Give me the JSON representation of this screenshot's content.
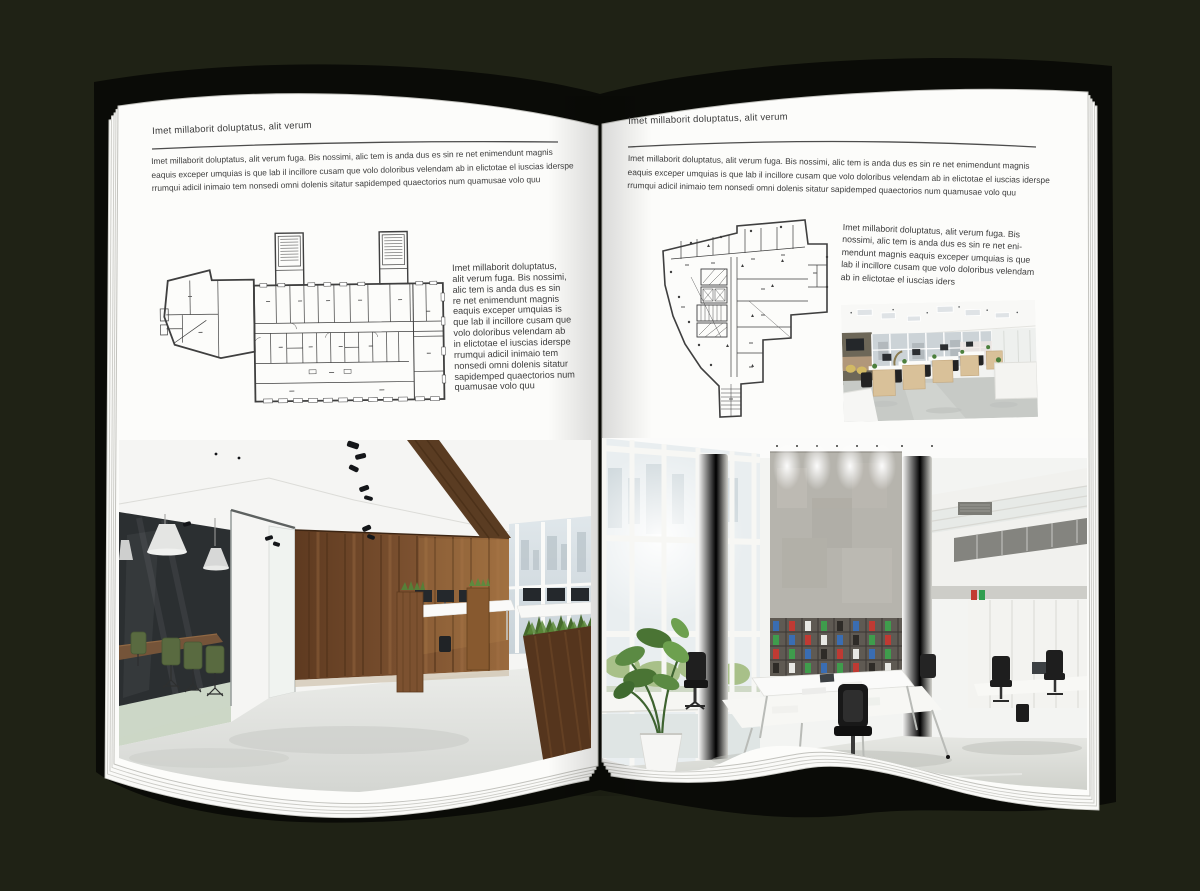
{
  "palette": {
    "background": "#1f2215",
    "cover": "#0a0b07",
    "page": "#fcfcfa",
    "text": "#3c3c3c",
    "rule": "#4d4d4d",
    "plan_line": "#3f3f3f",
    "wood": "#7a4f2c",
    "meeting_chair_green": "#4c5e2f",
    "binder_red": "#bf3a33",
    "binder_green": "#3f9c4c",
    "binder_blue": "#3a6db2"
  },
  "left_page": {
    "header": "Imet millaborit doluptatus, alit verum",
    "intro": "Imet millaborit doluptatus, alit verum fuga. Bis nossimi, alic tem is anda dus es sin re net enimendunt magnis\neaquis exceper umquias is que lab il incillore cusam que volo doloribus velendam ab in elictotae el iuscias iderspe\nrrumqui adicil inimaio tem nonsedi omni dolenis sitatur sapidemped quaectorios num quamusae volo quu",
    "caption": "Imet millaborit doluptatus,\nalit verum fuga. Bis nossimi,\nalic tem is anda dus es sin\nre net enimendunt magnis\neaquis exceper umquias is\nque lab il incillore cusam que\nvolo doloribus velendam ab\nin elictotae el iuscias iderspe\nrrumqui adicil inimaio tem\nnonsedi omni dolenis sitatur\nsapidemped quaectorios num\nquamusae volo quu",
    "floor_plan": "wide-office-building-floor-plan",
    "photo": "loft-office-with-glass-meeting-room"
  },
  "right_page": {
    "header": "Imet millaborit doluptatus, alit verum",
    "intro": "Imet millaborit doluptatus, alit verum fuga. Bis nossimi, alic tem is anda dus es sin re net enimendunt magnis\neaquis exceper umquias is que lab il incillore cusam que volo doloribus velendam ab in elictotae el iuscias iderspe\nrrumqui adicil inimaio tem nonsedi omni dolenis sitatur sapidemped quaectorios num quamusae volo quu",
    "caption": "Imet millaborit doluptatus, alit verum fuga. Bis\nnossimi, alic tem is anda dus es sin re net eni-\nmendunt magnis eaquis exceper umquias is que\nlab il incillore cusam que volo doloribus velendam\nab in elictotae el iuscias iders",
    "floor_plan": "irregular-tower-floor-plan",
    "photo_small": "open-plan-workstations-office",
    "photo_large": "double-height-white-office-atrium"
  }
}
